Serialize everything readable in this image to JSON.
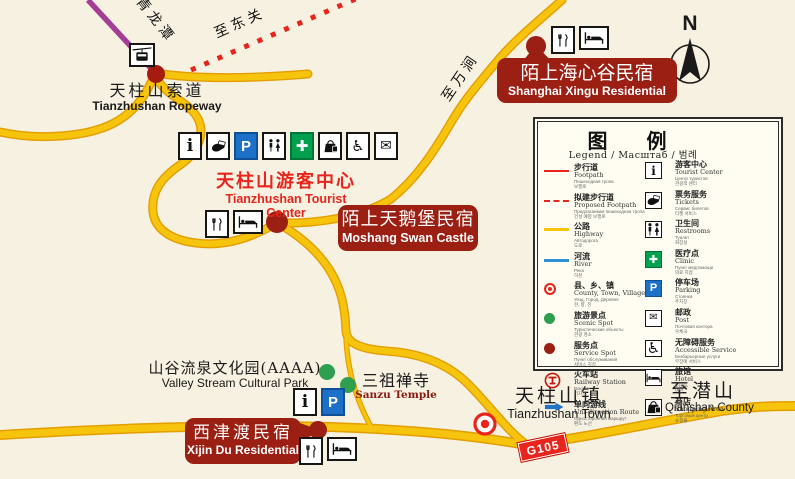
{
  "map": {
    "compass_label": "N",
    "road_badge": "G105",
    "colors": {
      "background": "#f6f1e1",
      "road_yellow": "#f7c40d",
      "road_casing": "#e39e00",
      "ropeway_purple": "#a43d96",
      "route_red": "#e8251c",
      "poi_dark_red": "#9b1f12",
      "scenic_green": "#2e9e4f",
      "parking_blue": "#1d70c8",
      "clinic_green": "#00a04e"
    },
    "route_labels": {
      "qinglongtan": "至青龙潭",
      "dongguan": "至东关",
      "wanjian": "至万涧"
    },
    "places": {
      "ropeway": {
        "zh": "天柱山索道",
        "en": "Tianzhushan Ropeway"
      },
      "tourist_center": {
        "zh": "天柱山游客中心",
        "en": "Tianzhushan Tourist Center",
        "icons": [
          "info",
          "tickets",
          "parking",
          "restrooms",
          "clinic",
          "shopping",
          "accessible",
          "post"
        ]
      },
      "moshang_swan_castle": {
        "zh": "陌上天鹅堡民宿",
        "en": "Moshang Swan Castle",
        "icons": [
          "restaurant",
          "hotel"
        ]
      },
      "shanghai_xingu": {
        "zh": "陌上海心谷民宿",
        "en": "Shanghai Xingu Residential",
        "icons": [
          "restaurant",
          "hotel"
        ]
      },
      "xijin_du": {
        "zh": "西津渡民宿",
        "en": "Xijin Du Residential",
        "icons": [
          "restaurant",
          "hotel"
        ]
      },
      "valley_park": {
        "zh": "山谷流泉文化园(AAAA)",
        "en": "Valley Stream Cultural Park",
        "icons": [
          "info",
          "parking"
        ]
      },
      "sanzu_temple": {
        "zh": "三祖禅寺",
        "en": "Sanzu Temple"
      },
      "tianzhushan_town": {
        "zh": "天柱山镇",
        "en": "Tianzhushan Town"
      },
      "qianshan": {
        "zh": "至潜山",
        "en": "to Qianshan County"
      }
    }
  },
  "legend": {
    "title": "图 例",
    "subtitle": "Legend / Масштаб / 범례",
    "left": [
      {
        "symbol": "footpath-line",
        "zh": "步行道",
        "en": "Footpath",
        "ru": "Пешеходная тропа",
        "ko": "보행로"
      },
      {
        "symbol": "proposed-footpath-line",
        "zh": "拟建步行道",
        "en": "Proposed Footpath",
        "ru": "Предлагаемая пешеходная тропа",
        "ko": "건설 예정 보행로"
      },
      {
        "symbol": "highway-line",
        "zh": "公路",
        "en": "Highway",
        "ru": "Автодорога",
        "ko": "도로"
      },
      {
        "symbol": "river-line",
        "zh": "河流",
        "en": "River",
        "ru": "Река",
        "ko": "하천"
      },
      {
        "symbol": "county-marker",
        "zh": "县、乡、镇",
        "en": "County, Town, Village",
        "ru": "Уезд, Город, Деревня",
        "ko": "현, 향, 진"
      },
      {
        "symbol": "scenic-marker",
        "zh": "旅游景点",
        "en": "Scenic Spot",
        "ru": "Туристические объекты",
        "ko": "관광 명소"
      },
      {
        "symbol": "service-marker",
        "zh": "服务点",
        "en": "Service Spot",
        "ru": "Пункт обслуживания",
        "ko": "서비스 지점"
      },
      {
        "symbol": "railway-marker",
        "zh": "火车站",
        "en": "Railway Station",
        "ru": "Вокзал",
        "ko": "기차역"
      },
      {
        "symbol": "route-arrow",
        "zh": "单向游线",
        "en": "Uni-direction Route",
        "ru": "Односторонний маршрут",
        "ko": "편도 노선"
      }
    ],
    "right": [
      {
        "icon": "info",
        "zh": "游客中心",
        "en": "Tourist Center",
        "ru": "Центр туристов",
        "ko": "관광객 센터"
      },
      {
        "icon": "tickets",
        "zh": "票务服务",
        "en": "Tickets",
        "ru": "Сервис билетов",
        "ko": "티켓 서비스"
      },
      {
        "icon": "restrooms",
        "zh": "卫生间",
        "en": "Restrooms",
        "ru": "Туалет",
        "ko": "화장실"
      },
      {
        "icon": "clinic",
        "zh": "医疗点",
        "en": "Clinic",
        "ru": "Пункт медпомощи",
        "ko": "의료 지점"
      },
      {
        "icon": "parking",
        "zh": "停车场",
        "en": "Parking",
        "ru": "Стоянка",
        "ko": "주차장"
      },
      {
        "icon": "post",
        "zh": "邮政",
        "en": "Post",
        "ru": "Почтовая контора",
        "ko": "우체국"
      },
      {
        "icon": "accessible",
        "zh": "无障碍服务",
        "en": "Accessible Service",
        "ru": "Безбарьерные услуги",
        "ko": "무장애 서비스"
      },
      {
        "icon": "hotel",
        "zh": "旅馆",
        "en": "Hotel",
        "ru": "Отель",
        "ko": "여관"
      },
      {
        "icon": "shopping",
        "zh": "商店",
        "en": "Shopping Area",
        "ru": "Торговый центр",
        "ko": "쇼핑몰"
      }
    ]
  }
}
